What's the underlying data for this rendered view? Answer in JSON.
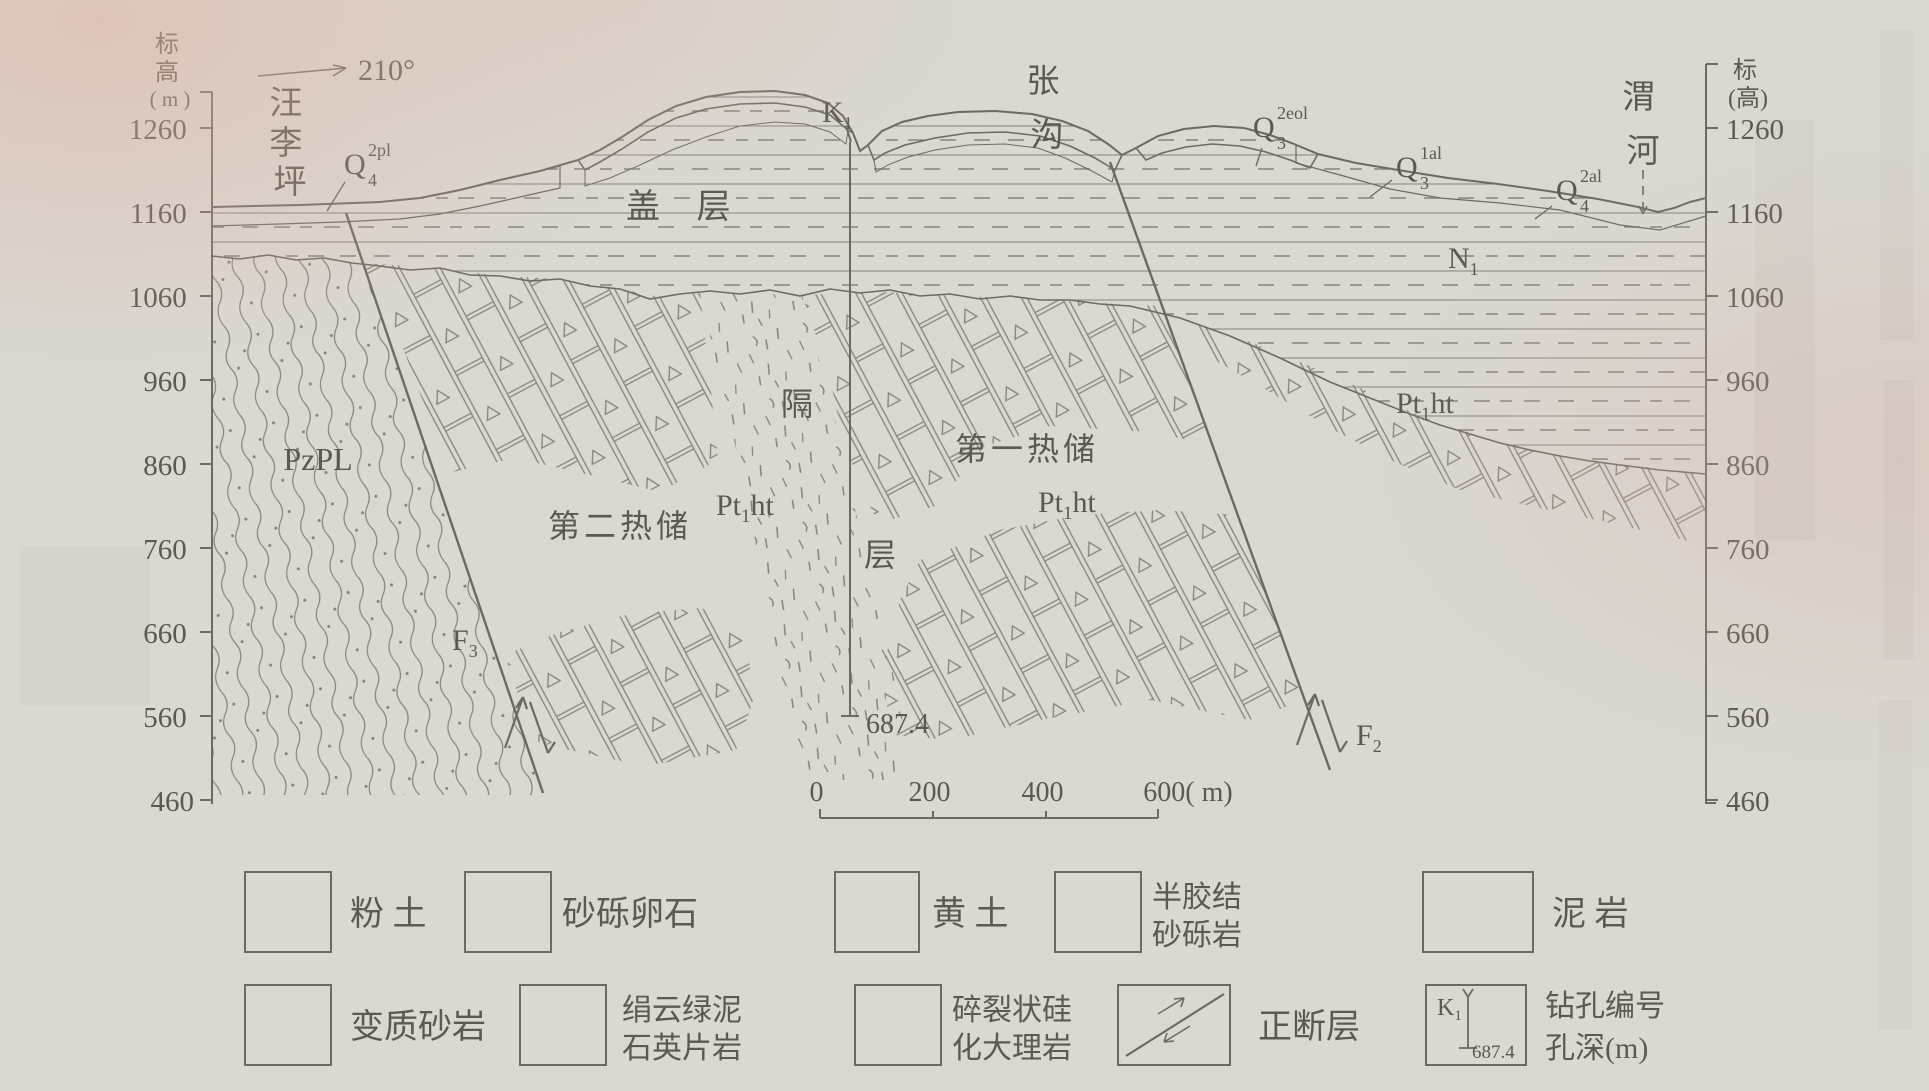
{
  "axes": {
    "left_title": [
      "标",
      "高",
      "( m )"
    ],
    "right_title": [
      "标",
      "(高)"
    ],
    "ticks": [
      "1260",
      "1160",
      "1060",
      "960",
      "860",
      "760",
      "660",
      "560",
      "460"
    ]
  },
  "compass_bearing": "210°",
  "places": {
    "wangliping": [
      "汪",
      "李",
      "坪"
    ],
    "zhanggou": [
      "张",
      "沟"
    ],
    "weihe": [
      "渭",
      "河"
    ]
  },
  "strata": {
    "q4_2pl": {
      "base": "Q",
      "sub": "4",
      "sup": "2pl"
    },
    "q3_2eol": {
      "base": "Q",
      "sub": "3",
      "sup": "2eol"
    },
    "q3_1al": {
      "base": "Q",
      "sub": "3",
      "sup": "1al"
    },
    "q4_2al": {
      "base": "Q",
      "sub": "4",
      "sup": "2al"
    },
    "k1": {
      "base": "K",
      "sub": "1"
    },
    "n1": {
      "base": "N",
      "sub": "1"
    },
    "pzpl": "PzPL",
    "pt1ht": {
      "base": "Pt",
      "sub": "1",
      "suffix": "ht"
    },
    "cover_layer": "盖 层",
    "aquitard": [
      "隔",
      "层"
    ],
    "reservoir_first": "第一热储",
    "reservoir_second": "第二热储",
    "f3": {
      "base": "F",
      "sub": "3"
    },
    "f2": {
      "base": "F",
      "sub": "2"
    },
    "borehole_depth": "687.4"
  },
  "scale_bar": {
    "labels": [
      "0",
      "200",
      "400",
      "600( m)"
    ]
  },
  "legend": {
    "items": [
      {
        "label1": "粉 土"
      },
      {
        "label1": "砂砾卵石"
      },
      {
        "label1": "黄 土"
      },
      {
        "label1": "半胶结",
        "label2": "砂砾岩"
      },
      {
        "label1": "泥 岩"
      },
      {
        "label1": "变质砂岩"
      },
      {
        "label1": "绢云绿泥",
        "label2": "石英片岩"
      },
      {
        "label1": "碎裂状硅",
        "label2": "化大理岩"
      },
      {
        "label1": "正断层"
      },
      {
        "label1": "钻孔编号",
        "label2": "孔深(m)"
      }
    ],
    "borehole_symbol": {
      "label": "K",
      "sub": "1",
      "depth": "687.4"
    }
  }
}
